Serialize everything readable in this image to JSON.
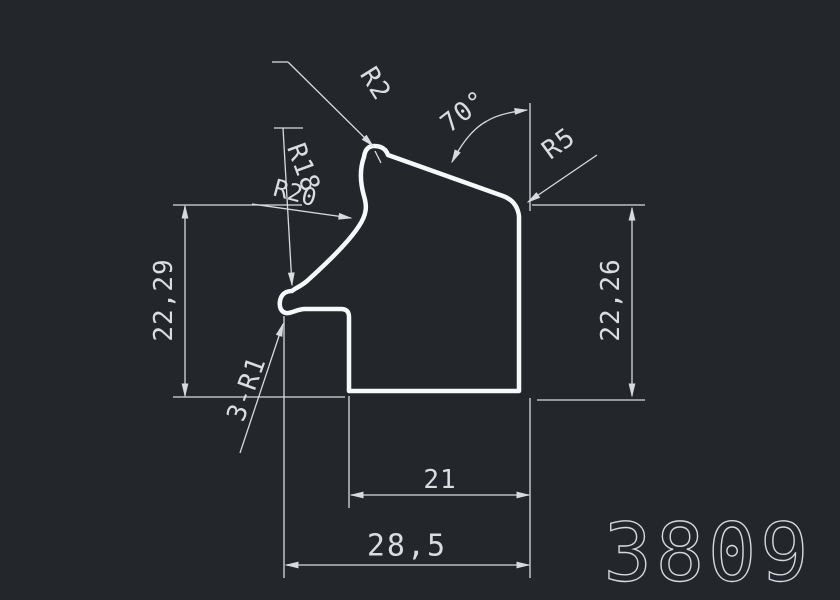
{
  "drawing": {
    "profile_number": "3809",
    "colors": {
      "background": "#23272c",
      "thin_line": "#d7dbdf",
      "profile_line": "#f7f8f9",
      "text": "#d9dde1"
    },
    "labels": {
      "radius_top": "R2",
      "angle": "70°",
      "radius_corner": "R5",
      "radius_large": "R18",
      "radius_arc": "R20",
      "fillets": "3-R1"
    },
    "dimensions": {
      "height_left": "22,29",
      "height_right": "22,26",
      "width_inner": "21",
      "width_total": "28,5"
    }
  }
}
